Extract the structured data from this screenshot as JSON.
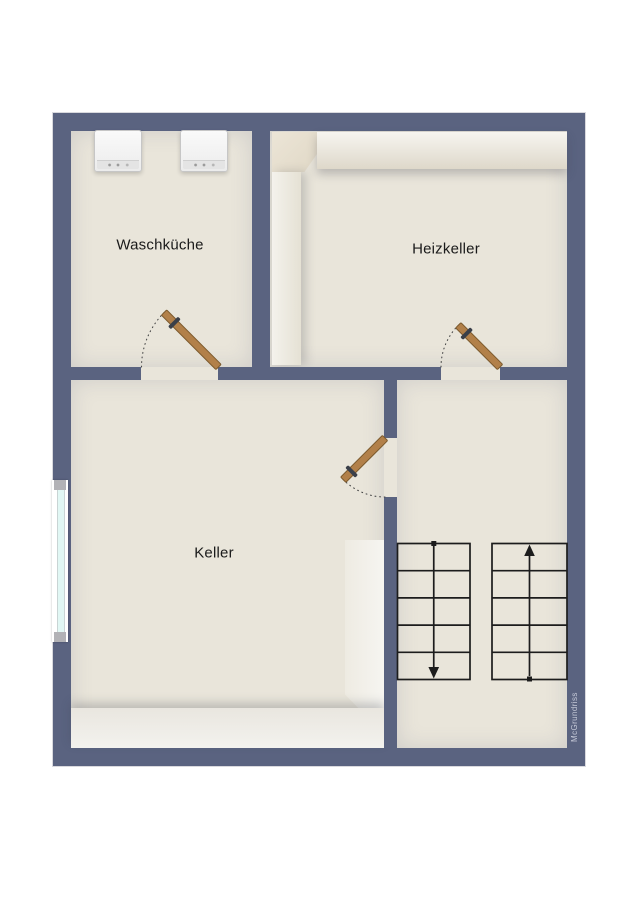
{
  "watermark": {
    "label": "McGrundriss"
  },
  "rooms": {
    "waschkueche": {
      "label": "Waschküche"
    },
    "heizkeller": {
      "label": "Heizkeller"
    },
    "keller": {
      "label": "Keller"
    }
  },
  "fixtures": {
    "washing_machines": {
      "count": 2,
      "icon": "washing-machine-top-view"
    },
    "window": {
      "count": 1,
      "location": "left-exterior-wall"
    },
    "doors": {
      "count": 3,
      "style": "swing-door-with-arc"
    },
    "staircase": {
      "flights": 2,
      "treads_per_flight": 5,
      "left_flight_direction": "down",
      "right_flight_direction": "up"
    }
  },
  "colors": {
    "page": "#ffffff",
    "wall": "#5a6380",
    "wall_outline": "#d9d9de",
    "floor": "#e9e5da",
    "door": "#b28049",
    "door_edge": "#7c5a2d",
    "swing_arc": "#4a4a4a",
    "stair_line": "#1c1c1c",
    "glass": "#e1f7f4",
    "frame": "#ffffff",
    "sill": "#b2b2b6",
    "machine_edge": "#c6c6c6",
    "label": "#1a1a1a",
    "watermark_color": "#c4c8d6"
  }
}
